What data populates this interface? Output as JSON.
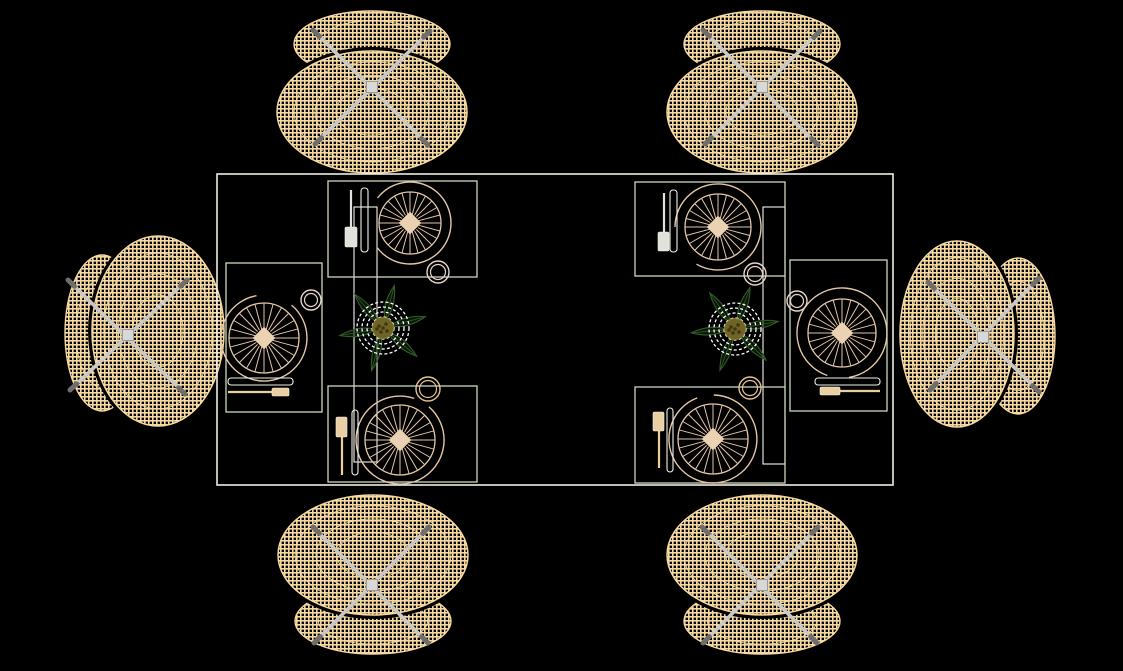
{
  "canvas": {
    "width": 1123,
    "height": 671,
    "background": "#000000"
  },
  "colors": {
    "chair_mesh": "#F6D99F",
    "chair_leg": "#C9C9C9",
    "chair_leg_tip": "#6E6E6E",
    "chair_hub": "#D8D8D8",
    "table_line": "#EDEEE2",
    "panel_line": "#F4F4EE",
    "placemat_line": "#CBD8BD",
    "plate_line": "#E2C6A8",
    "plate_center": "#EBD2B2",
    "cup_warm": "#E2C193",
    "cup_pale": "#E6D5CB",
    "fork_gray": "#E2E2DC",
    "cutlery_tan": "#E9CFA2",
    "knife_line": "#EFEFE8",
    "ring_white": "#FFFFFF",
    "leaf_green": "#2F5B26",
    "leaf_fill": "#142A0E",
    "flower_center": "#6F6425",
    "flower_speck": "#3F3812"
  },
  "table": {
    "outline": [
      217,
      174,
      676,
      311
    ],
    "panels": [
      [
        354,
        207,
        23,
        255
      ],
      [
        763,
        207,
        22,
        257
      ]
    ]
  },
  "chairs": [
    {
      "id": "chair-top-left",
      "back": {
        "cx": 372,
        "cy": 44,
        "rx": 78,
        "ry": 33
      },
      "seat": {
        "cx": 372,
        "cy": 112,
        "rx": 95,
        "ry": 61
      },
      "legs": [
        [
          313,
          30,
          428,
          145
        ],
        [
          430,
          31,
          315,
          144
        ]
      ],
      "hub": [
        372,
        87
      ]
    },
    {
      "id": "chair-top-right",
      "back": {
        "cx": 762,
        "cy": 44,
        "rx": 78,
        "ry": 33
      },
      "seat": {
        "cx": 762,
        "cy": 112,
        "rx": 95,
        "ry": 61
      },
      "legs": [
        [
          703,
          30,
          818,
          145
        ],
        [
          820,
          31,
          705,
          144
        ]
      ],
      "hub": [
        762,
        87
      ]
    },
    {
      "id": "chair-bottom-left",
      "back": {
        "cx": 373,
        "cy": 621,
        "rx": 78,
        "ry": 33
      },
      "seat": {
        "cx": 373,
        "cy": 555,
        "rx": 95,
        "ry": 60
      },
      "legs": [
        [
          313,
          527,
          428,
          643
        ],
        [
          429,
          527,
          314,
          643
        ]
      ],
      "hub": [
        372,
        585
      ]
    },
    {
      "id": "chair-bottom-right",
      "back": {
        "cx": 762,
        "cy": 621,
        "rx": 78,
        "ry": 33
      },
      "seat": {
        "cx": 762,
        "cy": 555,
        "rx": 95,
        "ry": 60
      },
      "legs": [
        [
          702,
          527,
          817,
          643
        ],
        [
          818,
          527,
          703,
          643
        ]
      ],
      "hub": [
        762,
        585
      ]
    },
    {
      "id": "chair-left",
      "back": {
        "cx": 102,
        "cy": 333,
        "rx": 37,
        "ry": 78
      },
      "seat": {
        "cx": 158,
        "cy": 331,
        "rx": 66,
        "ry": 95
      },
      "legs": [
        [
          68,
          280,
          185,
          394
        ],
        [
          187,
          280,
          70,
          390
        ]
      ],
      "hub": [
        128,
        335
      ]
    },
    {
      "id": "chair-right",
      "back": {
        "cx": 1018,
        "cy": 336,
        "rx": 37,
        "ry": 78
      },
      "seat": {
        "cx": 957,
        "cy": 334,
        "rx": 57,
        "ry": 93
      },
      "legs": [
        [
          928,
          282,
          1039,
          392
        ],
        [
          1039,
          278,
          930,
          390
        ]
      ],
      "hub": [
        983,
        337
      ]
    }
  ],
  "plate_style": {
    "spokes": 24,
    "hub_half": 8
  },
  "place_settings": [
    {
      "id": "place-setting-top-left",
      "mat": [
        328,
        181,
        149,
        96
      ],
      "plate": {
        "cx": 410,
        "cy": 223,
        "ro": 41,
        "ri": 31,
        "gap": 75,
        "dir": 180
      },
      "cup": {
        "cx": 438,
        "cy": 272,
        "r": 11,
        "color": "cup_pale"
      },
      "fork": {
        "shaft": [
          351,
          190,
          351,
          229
        ],
        "handle": [
          345,
          227,
          12,
          20
        ],
        "color": "fork_gray"
      },
      "knife": {
        "rect": [
          361,
          188,
          7,
          64
        ]
      }
    },
    {
      "id": "place-setting-top-right",
      "mat": [
        635,
        182,
        150,
        94
      ],
      "plate": {
        "cx": 718,
        "cy": 227,
        "ro": 43,
        "ri": 33,
        "gap": 60,
        "dir": 150
      },
      "cup": {
        "cx": 755,
        "cy": 274,
        "r": 11,
        "color": "cup_pale"
      },
      "fork": {
        "shaft": [
          664,
          193,
          664,
          233
        ],
        "handle": [
          658,
          232,
          11,
          19
        ],
        "color": "fork_gray"
      },
      "knife": {
        "rect": [
          670,
          190,
          7,
          62
        ]
      }
    },
    {
      "id": "place-setting-bottom-left",
      "mat": [
        328,
        386,
        149,
        96
      ],
      "plate": {
        "cx": 400,
        "cy": 440,
        "ro": 44,
        "ri": 35,
        "gap": 22,
        "dir": 300
      },
      "cup": {
        "cx": 428,
        "cy": 389,
        "r": 12,
        "color": "cup_warm"
      },
      "fork": {
        "shaft": [
          342,
          436,
          342,
          475
        ],
        "handle": [
          336,
          417,
          11,
          20
        ],
        "color": "cutlery_tan"
      },
      "knife": {
        "rect": [
          352,
          410,
          6,
          65
        ]
      }
    },
    {
      "id": "place-setting-bottom-right",
      "mat": [
        635,
        387,
        150,
        96
      ],
      "plate": {
        "cx": 713,
        "cy": 439,
        "ro": 44,
        "ri": 35,
        "gap": 22,
        "dir": 260
      },
      "cup": {
        "cx": 750,
        "cy": 388,
        "r": 11,
        "color": "cup_warm"
      },
      "fork": {
        "shaft": [
          659,
          430,
          659,
          468
        ],
        "handle": [
          653,
          412,
          11,
          19
        ],
        "color": "cutlery_tan"
      },
      "knife": {
        "rect": [
          667,
          408,
          6,
          64
        ]
      }
    },
    {
      "id": "place-setting-left",
      "mat": [
        226,
        263,
        96,
        149
      ],
      "plate": {
        "cx": 264,
        "cy": 338,
        "ro": 43,
        "ri": 35,
        "gap": 50,
        "dir": 285
      },
      "cup": {
        "cx": 311,
        "cy": 300,
        "r": 10,
        "color": "cup_pale"
      },
      "fork": {
        "shaft": [
          228,
          392,
          274,
          392
        ],
        "handle": [
          272,
          388,
          17,
          8
        ],
        "color": "cutlery_tan"
      },
      "knife": {
        "rect": [
          228,
          378,
          65,
          7
        ]
      }
    },
    {
      "id": "place-setting-right",
      "mat": [
        790,
        260,
        97,
        151
      ],
      "plate": {
        "cx": 842,
        "cy": 333,
        "ro": 45,
        "ri": 34,
        "gap": 28,
        "dir": 95
      },
      "cup": {
        "cx": 797,
        "cy": 301,
        "r": 10,
        "color": "cup_pale"
      },
      "fork": {
        "shaft": [
          838,
          391,
          880,
          391
        ],
        "handle": [
          820,
          387,
          20,
          8
        ],
        "color": "cutlery_tan"
      },
      "knife": {
        "rect": [
          815,
          378,
          65,
          7
        ]
      }
    }
  ],
  "centerpieces": [
    {
      "id": "centerpiece-left",
      "cx": 383,
      "cy": 328,
      "leaf_angles": [
        -75,
        -15,
        40,
        105,
        170,
        230
      ],
      "rings": [
        26,
        21,
        16,
        11
      ],
      "leaf": {
        "len": 44,
        "width": 15,
        "inner": 8
      },
      "flower_r": 10.5
    },
    {
      "id": "centerpiece-right",
      "cx": 735,
      "cy": 329,
      "leaf_angles": [
        -70,
        -10,
        45,
        110,
        175,
        235
      ],
      "rings": [
        26,
        21,
        16,
        11
      ],
      "leaf": {
        "len": 44,
        "width": 15,
        "inner": 8
      },
      "flower_r": 10.5
    }
  ]
}
